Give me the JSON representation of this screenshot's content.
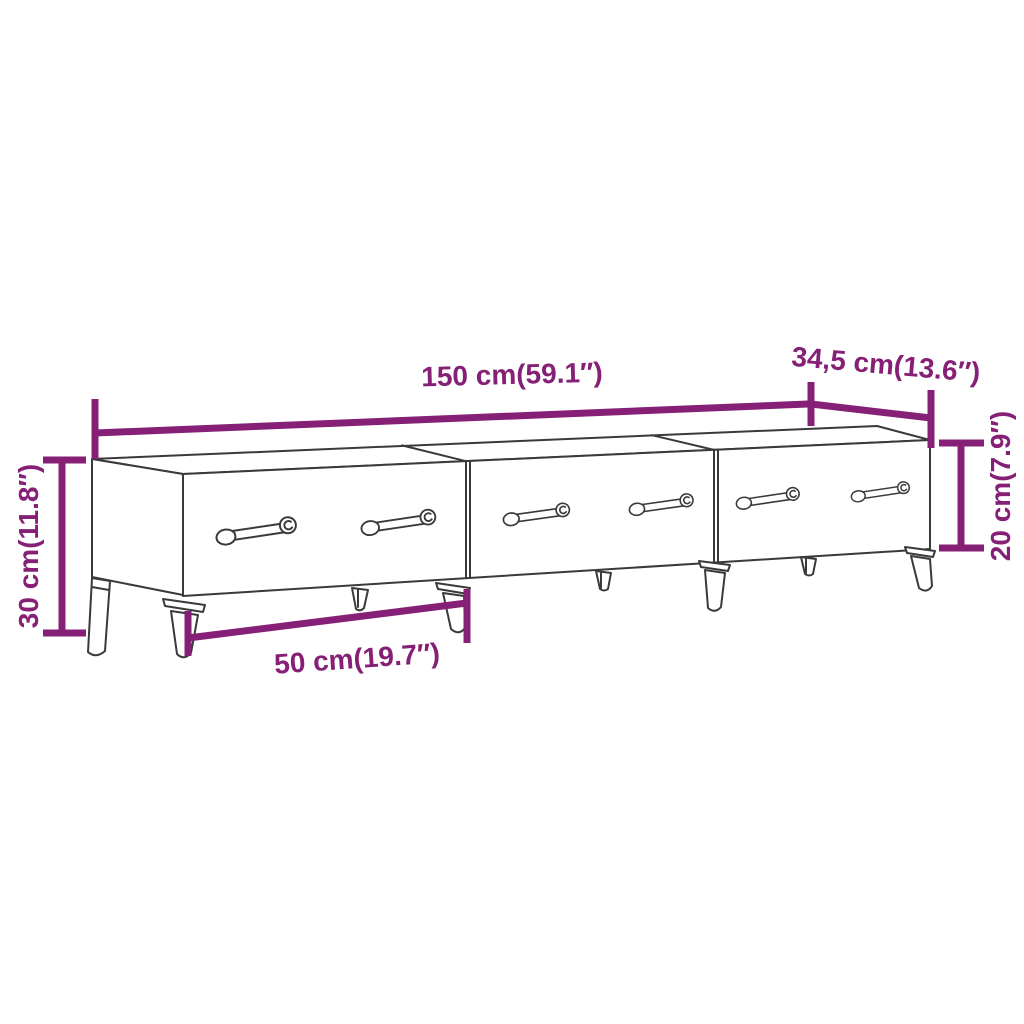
{
  "diagram": {
    "type": "product-dimension-diagram",
    "product": "TV stand with three drawers and metal legs",
    "background_color": "#ffffff",
    "line_color": "#3a3a3a",
    "accent_color": "#862076",
    "dimensions": {
      "width_top": {
        "label": "150 cm(59.1″)",
        "meaning": "overall width"
      },
      "depth_top": {
        "label": "34,5 cm(13.6″)",
        "meaning": "depth"
      },
      "height_left": {
        "label": "30 cm(11.8″)",
        "meaning": "overall height"
      },
      "drawer_height_right": {
        "label": "20 cm(7.9″)",
        "meaning": "cabinet body height"
      },
      "leg_span_bottom": {
        "label": "50 cm(19.7″)",
        "meaning": "leg spacing"
      }
    }
  }
}
